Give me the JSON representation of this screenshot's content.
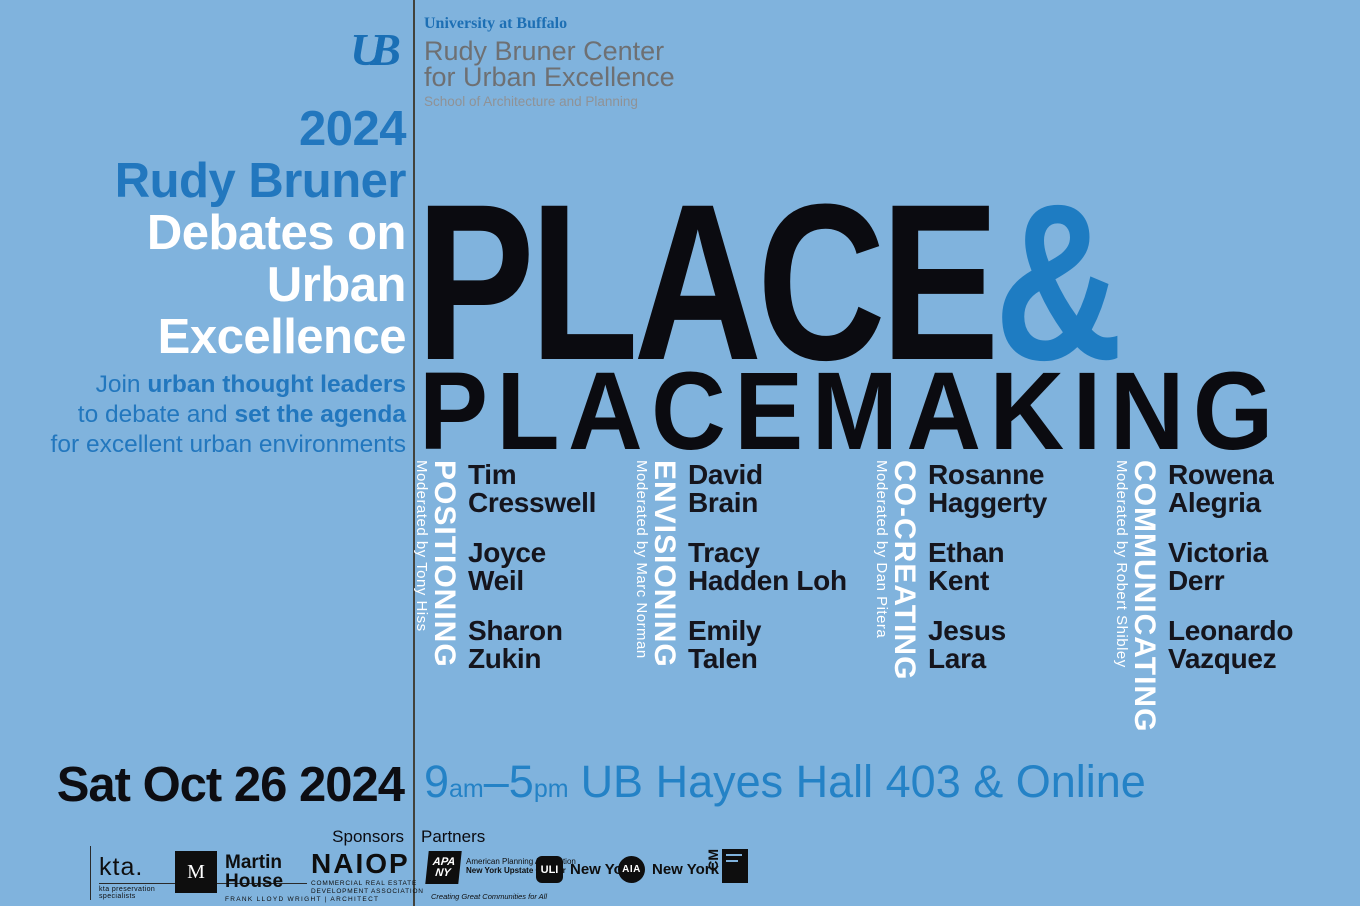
{
  "colors": {
    "background": "#80b3dd",
    "accent_blue": "#2277be",
    "title_black": "#0b0b10",
    "white": "#ffffff",
    "header_gray": "#6e7073",
    "school_gray": "#8f9296",
    "divider": "#42423c",
    "logo_black": "#0e0e0e"
  },
  "header": {
    "ub_logo": "UB",
    "university": "University at Buffalo",
    "center_line1": "Rudy Bruner Center",
    "center_line2": "for Urban Excellence",
    "school": "School of Architecture and Planning"
  },
  "left_block": {
    "year": "2024",
    "name": "Rudy Bruner",
    "white_lines": [
      "Debates on",
      "Urban",
      "Excellence"
    ],
    "tagline_lines": [
      {
        "pre": "Join ",
        "bold": "urban thought leaders"
      },
      {
        "pre": "to debate and ",
        "bold": "set the agenda"
      },
      {
        "pre": "for excellent urban environments",
        "bold": ""
      }
    ]
  },
  "main_title": {
    "word1": "PLACE",
    "amp": "&",
    "word2": "PLACEMAKING"
  },
  "panels": [
    {
      "category": "POSITIONING",
      "moderator": "Moderated by Tony Hiss",
      "speakers": [
        {
          "first": "Tim",
          "last": "Cresswell"
        },
        {
          "first": "Joyce",
          "last": "Weil"
        },
        {
          "first": "Sharon",
          "last": "Zukin"
        }
      ]
    },
    {
      "category": "ENVISIONING",
      "moderator": "Moderated by Marc Norman",
      "speakers": [
        {
          "first": "David",
          "last": "Brain"
        },
        {
          "first": "Tracy",
          "last": "Hadden Loh"
        },
        {
          "first": "Emily",
          "last": "Talen"
        }
      ]
    },
    {
      "category": "CO-CREATING",
      "moderator": "Moderated by Dan Pitera",
      "speakers": [
        {
          "first": "Rosanne",
          "last": "Haggerty"
        },
        {
          "first": "Ethan",
          "last": "Kent"
        },
        {
          "first": "Jesus",
          "last": "Lara"
        }
      ]
    },
    {
      "category": "COMMUNICATING",
      "moderator": "Moderated by Robert Shibley",
      "speakers": [
        {
          "first": "Rowena",
          "last": "Alegria"
        },
        {
          "first": "Victoria",
          "last": "Derr"
        },
        {
          "first": "Leonardo",
          "last": "Vazquez"
        }
      ]
    }
  ],
  "event": {
    "date": "Sat Oct 26 2024",
    "time_start": "9",
    "time_start_suffix": "am",
    "time_dash": "–",
    "time_end": "5",
    "time_end_suffix": "pm",
    "location": "UB Hayes Hall 403 & Online"
  },
  "footer": {
    "sponsors_label": "Sponsors",
    "partners_label": "Partners",
    "sponsors": {
      "kta": {
        "name": "kta.",
        "tagline": "kta preservation specialists"
      },
      "martin_house": {
        "mark": "M",
        "line1": "Martin",
        "line2": "House",
        "tagline": "FRANK LLOYD WRIGHT  |  ARCHITECT"
      },
      "naiop": {
        "name": "NAIOP",
        "tagline1": "COMMERCIAL REAL ESTATE",
        "tagline2": "DEVELOPMENT ASSOCIATION"
      }
    },
    "partners": {
      "apa_ny": {
        "mark_line1": "APA",
        "mark_line2": "NY",
        "line1": "American Planning Association",
        "line2": "New York Upstate Chapter",
        "tagline": "Creating Great Communities for All"
      },
      "uli": {
        "mark": "ULI",
        "label": "New York"
      },
      "aia": {
        "mark": "AIA",
        "label": "New York"
      },
      "cm": {
        "mark": "CM"
      }
    }
  }
}
